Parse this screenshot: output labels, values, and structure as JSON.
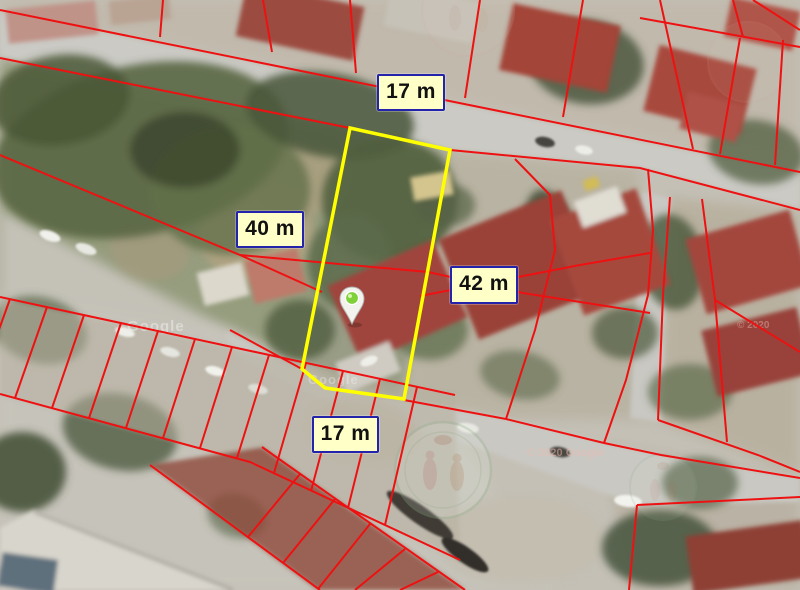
{
  "map": {
    "type": "satellite-cadastral-parcel-view",
    "measurement_labels": [
      {
        "id": "top-frontage",
        "text": "17 m"
      },
      {
        "id": "left-depth",
        "text": "40 m"
      },
      {
        "id": "right-depth",
        "text": "42 m"
      },
      {
        "id": "bottom-frontage",
        "text": "17 m"
      }
    ],
    "watermarks": {
      "google_1": "Google",
      "google_2": "Google",
      "copyright_1": "© 2020 Google",
      "copyright_2": "© 2020"
    },
    "colors": {
      "parcel_line": "#ee1111",
      "highlight_parcel": "#ffff00",
      "label_background": "#ffffc8",
      "label_border": "#2323ac",
      "label_text": "#111111",
      "pin_green": "#7fd13a"
    }
  }
}
